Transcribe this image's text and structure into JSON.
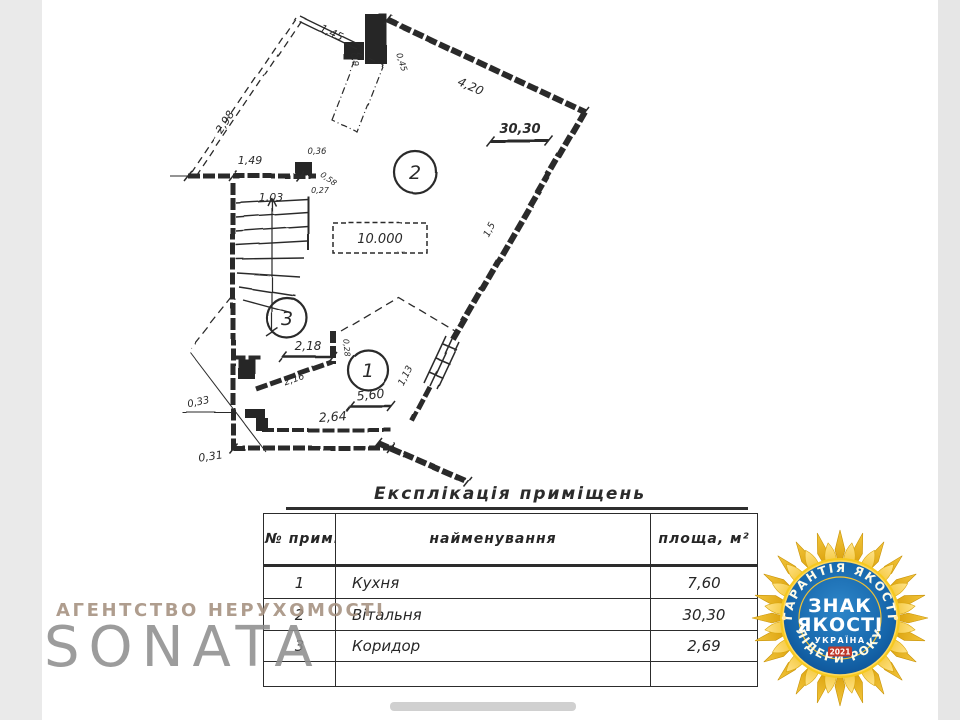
{
  "plan": {
    "rooms": {
      "r1": "1",
      "r2": "2",
      "r3": "3"
    },
    "elevation": "10.000",
    "labels": {
      "l145": "1,45",
      "l09": "0,9",
      "l045": "0,45",
      "l420": "4,20",
      "l3030": "30,30",
      "l298": "2,98",
      "l149": "1,49",
      "l036": "0,36",
      "l058": "0,58",
      "l027": "0,27",
      "l103": "1,03",
      "l218": "2,18",
      "l028": "0,28",
      "l216": "2,16",
      "l033": "0,33",
      "l031": "0,31",
      "l264": "2,64",
      "l560": "5,60",
      "l113": "1,13",
      "l15": "1,5"
    },
    "ink_color": "#2a2a2a"
  },
  "table": {
    "title": "Експлікація приміщень",
    "headers": {
      "num": "№ прим.",
      "name": "найменування",
      "area": "площа, м²"
    },
    "rows": [
      {
        "num": "1",
        "name": "Кухня",
        "area": "7,60"
      },
      {
        "num": "2",
        "name": "Вітальня",
        "area": "30,30"
      },
      {
        "num": "3",
        "name": "Коридор",
        "area": "2,69"
      },
      {
        "num": "",
        "name": "",
        "area": ""
      }
    ]
  },
  "watermark": {
    "agency": "АГЕНТСТВО НЕРУХОМОСТІ",
    "brand": "SONATA"
  },
  "badge": {
    "arc_top": "ГАРАНТІЯ ЯКОСТІ",
    "arc_bottom": "ЛІДЕРИ РОКУ",
    "center_line1": "ЗНАК",
    "center_line2": "ЯКОСТІ",
    "country": "УКРАЇНА",
    "year": "2021",
    "colors": {
      "gold": "#f2c11a",
      "gold_dark": "#d79b06",
      "blue": "#1565aa",
      "red": "#c0392b"
    }
  }
}
